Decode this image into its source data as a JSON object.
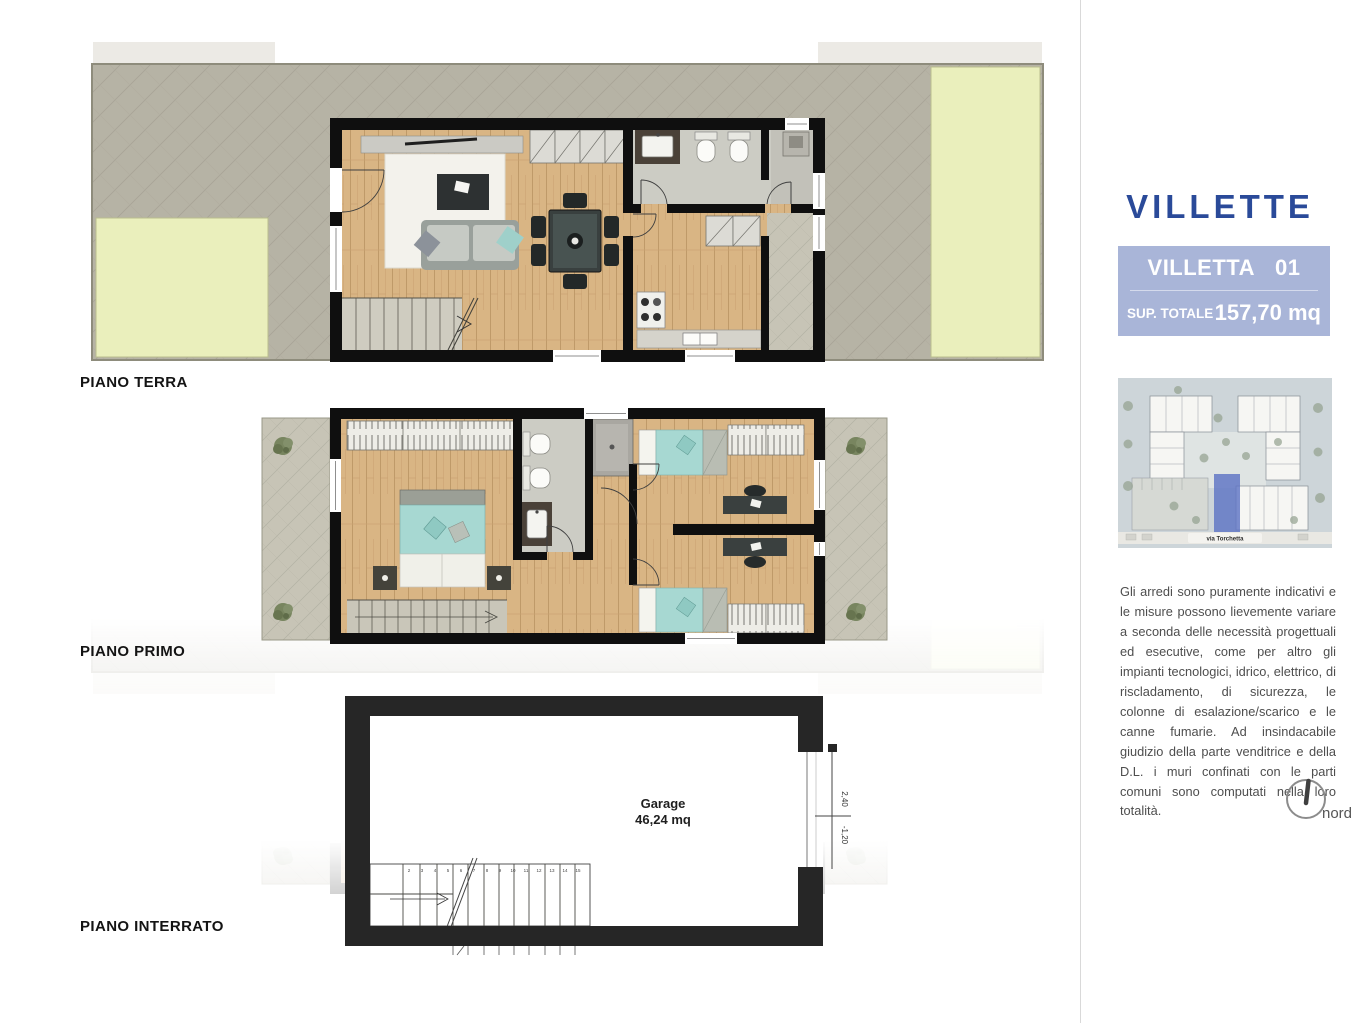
{
  "floor_plans": {
    "terra": {
      "label": "PIANO TERRA"
    },
    "primo": {
      "label": "PIANO PRIMO"
    },
    "interrato": {
      "label": "PIANO INTERRATO",
      "garage_label": "Garage",
      "garage_area": "46,24 mq",
      "level_upper": "2,40",
      "level_lower": "-1,20",
      "stair_numbers": [
        "2",
        "3",
        "4",
        "5",
        "6",
        "7",
        "8",
        "9",
        "10",
        "11",
        "12",
        "13",
        "14",
        "15"
      ]
    }
  },
  "sidebar": {
    "title": "VILLETTE",
    "unit_card": {
      "name": "VILLETTA",
      "number": "01",
      "sup_label": "SUP. TOTALE",
      "sup_value": "157,70 mq"
    },
    "site_map": {
      "street_label": "via Torchetta"
    },
    "disclaimer": "Gli arredi sono puramente indicativi e le misure possono lievemente variare a seconda delle necessità progettuali ed esecutive, come per altro gli impianti tecnologici, idrico, elettrico, di riscladamento, di sicurezza, le colonne di esalazione/scarico e le canne fumarie. Ad insindacabile giudizio della parte venditrice e della D.L. i muri confinati con le parti comuni sono computati nella loro totalità.",
    "north_label": "nord"
  },
  "colors": {
    "title_blue": "#2a4a99",
    "card_blue": "#a9b5d8",
    "wall_black": "#0f0f0f",
    "wood": "#d9b584",
    "lawn": "#eaefbc",
    "paving": "#b6b3a5",
    "teal_bed": "#a7d8d2",
    "site_highlight": "#5e74c5"
  }
}
